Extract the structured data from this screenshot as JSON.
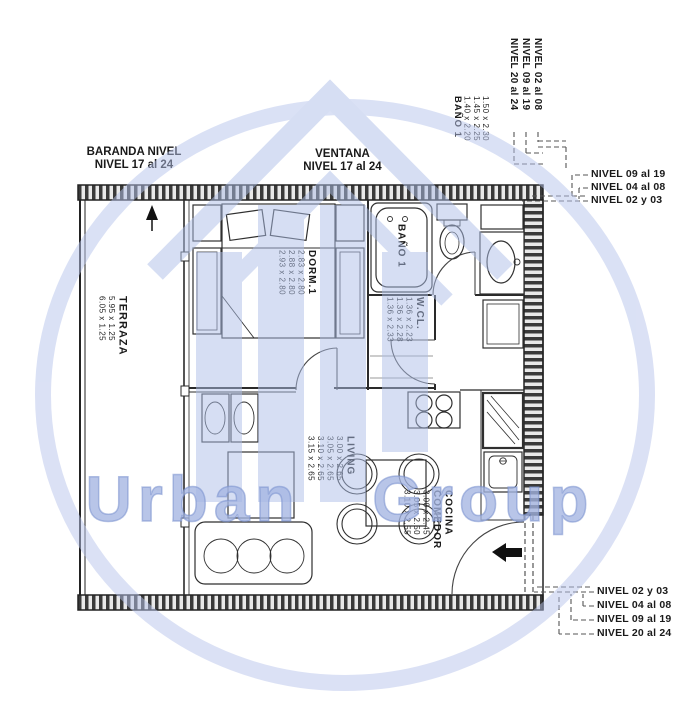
{
  "watermark": {
    "word1": "Urban",
    "word2": "Group",
    "color": "#a4b5e2"
  },
  "colors": {
    "line": "#333333",
    "wall_dark": "#3a3a3a",
    "watermark_blue": "#a4b5e2"
  },
  "labels": {
    "baranda": {
      "line1": "BARANDA NIVEL",
      "line2": "NIVEL 17 al 24"
    },
    "ventana": {
      "line1": "VENTANA",
      "line2": "NIVEL 17 al 24"
    }
  },
  "nivel_top": [
    "NIVEL 20 al 24",
    "NIVEL 09 al 19",
    "NIVEL 02 al 08"
  ],
  "nivel_right": [
    "NIVEL 09 al 19",
    "NIVEL 04 al 08",
    "NIVEL 02 y 03"
  ],
  "nivel_bottom": [
    "NIVEL 02 y 03",
    "NIVEL 04 al 08",
    "NIVEL 09 al 19",
    "NIVEL 20 al 24"
  ],
  "rooms": {
    "terraza": {
      "name": "TERRAZA",
      "dims": [
        "5.95 x 1.25",
        "6.05 x 1.25"
      ]
    },
    "dorm1": {
      "name": "DORM.1",
      "dims": [
        "2.83 x 2.80",
        "2.88 x 2.80",
        "2.93 x 2.80"
      ]
    },
    "wcl": {
      "name": "W.CL.",
      "dims": [
        "1.36 x 2.23",
        "1.36 x 2.28",
        "1.36 x 2.33"
      ]
    },
    "bano_top": {
      "name": "BAÑO 1",
      "dims": [
        "1.40 x 2.20",
        "1.45 x 2.25",
        "1.50 x 2.30"
      ]
    },
    "bano_tub": {
      "name": "BAÑO 1"
    },
    "living": {
      "name": "LIVING",
      "dims": [
        "3.00 x 2.65",
        "3.05 x 2.65",
        "3.10 x 2.65",
        "3.15 x 2.65"
      ]
    },
    "cocina": {
      "line1": "COCINA",
      "line2": "COMEDOR",
      "dims": [
        "3.00 x 2.45",
        "3.05 x 2.50",
        "3.10 x 2.55"
      ]
    }
  }
}
